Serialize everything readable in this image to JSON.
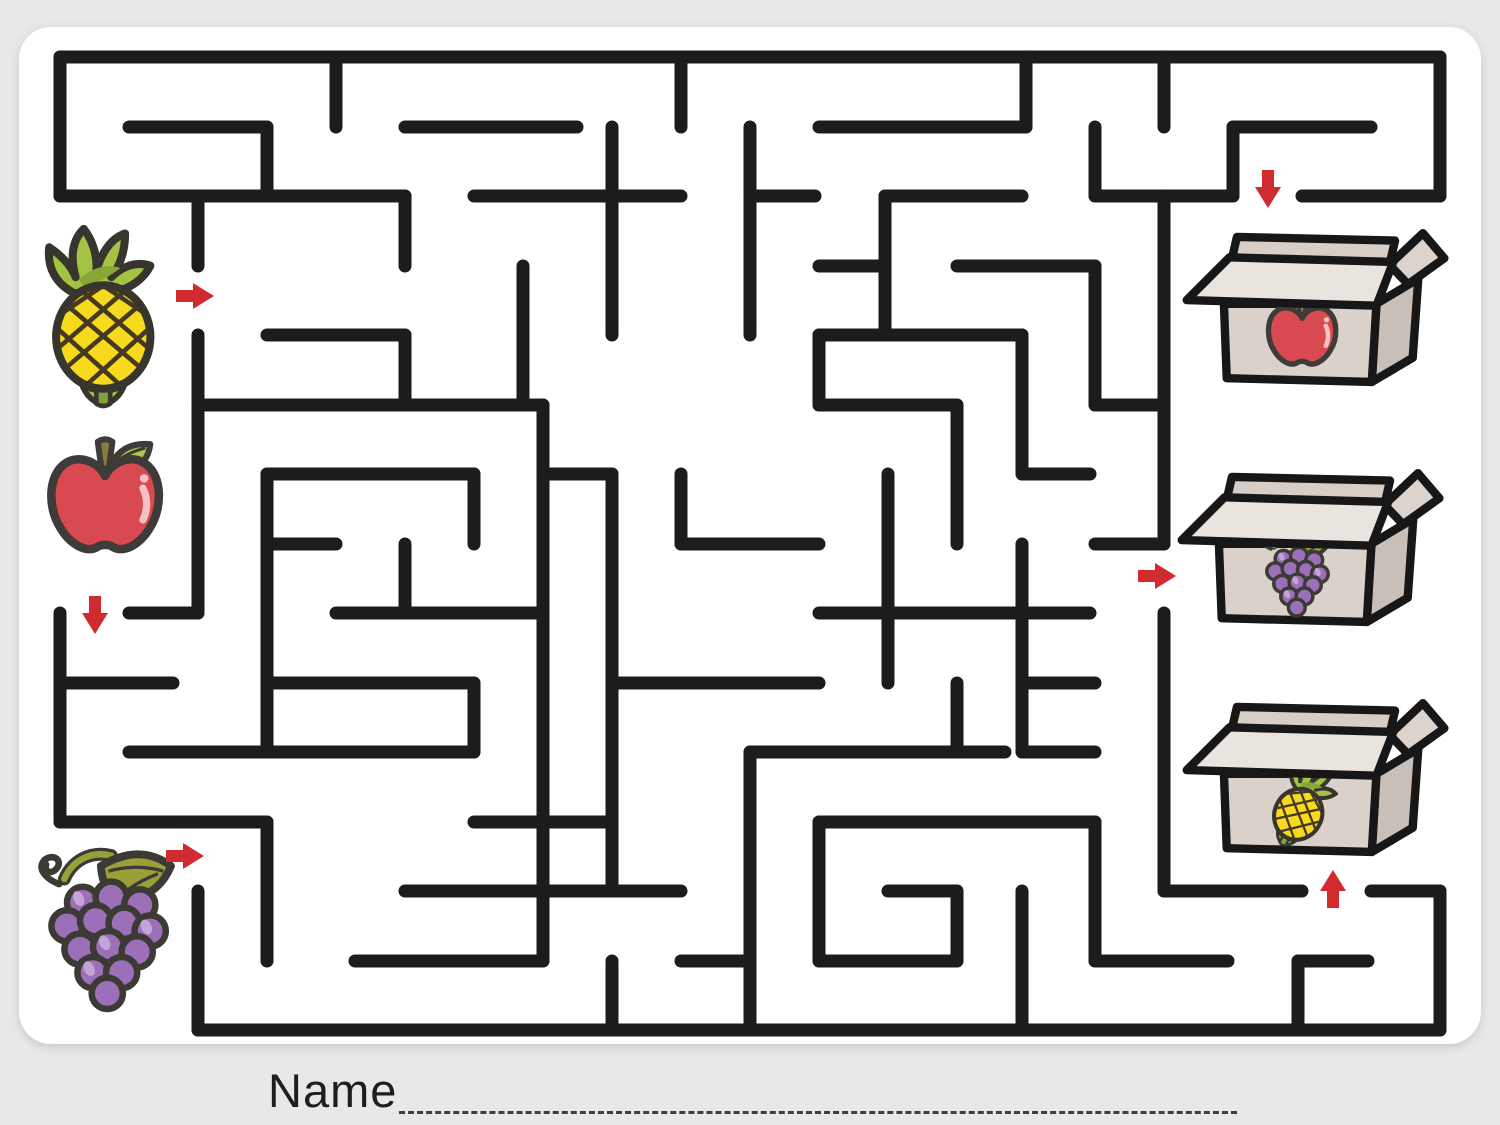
{
  "worksheet": {
    "title_label": "Name",
    "background_color": "#e7e8e9",
    "card_color": "#ffffff"
  },
  "maze": {
    "wall_color": "#1d1c1a",
    "stroke_width": 13,
    "walls": [
      [
        60,
        57,
        1440,
        57
      ],
      [
        1440,
        57,
        1440,
        196
      ],
      [
        1302,
        196,
        1440,
        196
      ],
      [
        1233,
        127,
        1233,
        196
      ],
      [
        1233,
        127,
        1371,
        127
      ],
      [
        1164,
        57,
        1164,
        127
      ],
      [
        1095,
        127,
        1095,
        196
      ],
      [
        1095,
        196,
        1233,
        196
      ],
      [
        1164,
        196,
        1164,
        544
      ],
      [
        1095,
        544,
        1164,
        544
      ],
      [
        1164,
        613,
        1164,
        891
      ],
      [
        1164,
        891,
        1302,
        891
      ],
      [
        1371,
        891,
        1440,
        891
      ],
      [
        1440,
        891,
        1440,
        1030
      ],
      [
        198,
        1030,
        1440,
        1030
      ],
      [
        198,
        891,
        198,
        1030
      ],
      [
        60,
        822,
        267,
        822
      ],
      [
        267,
        822,
        267,
        961
      ],
      [
        60,
        613,
        60,
        822
      ],
      [
        129,
        613,
        198,
        613
      ],
      [
        198,
        335,
        198,
        613
      ],
      [
        198,
        196,
        198,
        266
      ],
      [
        60,
        196,
        198,
        196
      ],
      [
        60,
        57,
        60,
        196
      ],
      [
        129,
        127,
        267,
        127
      ],
      [
        267,
        127,
        267,
        196
      ],
      [
        336,
        57,
        336,
        127
      ],
      [
        405,
        127,
        577,
        127
      ],
      [
        198,
        196,
        405,
        196
      ],
      [
        405,
        196,
        405,
        266
      ],
      [
        405,
        335,
        405,
        405
      ],
      [
        267,
        335,
        405,
        335
      ],
      [
        523,
        266,
        523,
        405
      ],
      [
        198,
        405,
        543,
        405
      ],
      [
        543,
        405,
        543,
        961
      ],
      [
        267,
        474,
        474,
        474
      ],
      [
        474,
        474,
        474,
        544
      ],
      [
        267,
        544,
        336,
        544
      ],
      [
        405,
        544,
        405,
        613
      ],
      [
        336,
        613,
        543,
        613
      ],
      [
        267,
        683,
        474,
        683
      ],
      [
        267,
        474,
        267,
        752
      ],
      [
        129,
        752,
        474,
        752
      ],
      [
        474,
        683,
        474,
        752
      ],
      [
        612,
        127,
        612,
        335
      ],
      [
        474,
        196,
        681,
        196
      ],
      [
        681,
        57,
        681,
        127
      ],
      [
        819,
        127,
        1026,
        127
      ],
      [
        1026,
        57,
        1026,
        127
      ],
      [
        750,
        127,
        750,
        335
      ],
      [
        750,
        196,
        815,
        196
      ],
      [
        885,
        196,
        1022,
        196
      ],
      [
        885,
        196,
        885,
        335
      ],
      [
        819,
        266,
        885,
        266
      ],
      [
        957,
        266,
        1095,
        266
      ],
      [
        1095,
        266,
        1095,
        405
      ],
      [
        1095,
        405,
        1164,
        405
      ],
      [
        819,
        335,
        1022,
        335
      ],
      [
        819,
        335,
        819,
        405
      ],
      [
        1022,
        335,
        1022,
        474
      ],
      [
        1022,
        474,
        1090,
        474
      ],
      [
        819,
        405,
        957,
        405
      ],
      [
        957,
        405,
        957,
        544
      ],
      [
        543,
        474,
        612,
        474
      ],
      [
        612,
        474,
        612,
        891
      ],
      [
        681,
        474,
        681,
        544
      ],
      [
        681,
        544,
        819,
        544
      ],
      [
        888,
        474,
        888,
        683
      ],
      [
        819,
        613,
        1090,
        613
      ],
      [
        1022,
        544,
        1022,
        752
      ],
      [
        612,
        683,
        819,
        683
      ],
      [
        1026,
        683,
        1095,
        683
      ],
      [
        957,
        683,
        957,
        752
      ],
      [
        750,
        752,
        1005,
        752
      ],
      [
        750,
        752,
        750,
        1030
      ],
      [
        1022,
        752,
        1095,
        752
      ],
      [
        819,
        822,
        1095,
        822
      ],
      [
        819,
        822,
        819,
        961
      ],
      [
        819,
        961,
        957,
        961
      ],
      [
        957,
        891,
        957,
        961
      ],
      [
        888,
        891,
        957,
        891
      ],
      [
        1095,
        822,
        1095,
        961
      ],
      [
        1095,
        961,
        1228,
        961
      ],
      [
        1298,
        961,
        1298,
        1030
      ],
      [
        1298,
        961,
        1368,
        961
      ],
      [
        1022,
        891,
        1022,
        1030
      ],
      [
        405,
        891,
        681,
        891
      ],
      [
        355,
        961,
        543,
        961
      ],
      [
        612,
        961,
        612,
        1030
      ],
      [
        681,
        961,
        750,
        961
      ],
      [
        474,
        822,
        612,
        822
      ],
      [
        60,
        683,
        173,
        683
      ]
    ]
  },
  "arrow": {
    "color": "#d02b2f"
  },
  "arrows": [
    {
      "name": "pineapple-start-arrow",
      "x": 176,
      "y": 296,
      "dir": "right"
    },
    {
      "name": "apple-start-arrow",
      "x": 95,
      "y": 596,
      "dir": "down"
    },
    {
      "name": "grapes-start-arrow",
      "x": 166,
      "y": 856,
      "dir": "right"
    },
    {
      "name": "apple-box-arrow",
      "x": 1268,
      "y": 170,
      "dir": "down"
    },
    {
      "name": "grapes-box-arrow",
      "x": 1138,
      "y": 576,
      "dir": "right"
    },
    {
      "name": "pineapple-box-arrow",
      "x": 1333,
      "y": 908,
      "dir": "up"
    }
  ],
  "start_items": [
    {
      "fruit": "pineapple",
      "x": 40,
      "y": 222,
      "scale": 1.15
    },
    {
      "fruit": "apple",
      "x": 38,
      "y": 432,
      "scale": 1.22
    },
    {
      "fruit": "grapes",
      "x": 28,
      "y": 840,
      "scale": 1.3
    }
  ],
  "boxes": [
    {
      "contains": "apple",
      "x": 1183,
      "y": 222,
      "scale": 0.93,
      "fruit": {
        "x": 83,
        "y": 74,
        "scale": 0.82,
        "rotate": 0
      }
    },
    {
      "contains": "grapes",
      "x": 1178,
      "y": 462,
      "scale": 0.93,
      "fruit": {
        "x": 82,
        "y": 68,
        "scale": 0.75,
        "rotate": 0
      }
    },
    {
      "contains": "pineapple",
      "x": 1183,
      "y": 692,
      "scale": 0.93,
      "fruit": {
        "x": 100,
        "y": 72,
        "scale": 0.62,
        "rotate": 28
      }
    }
  ],
  "palette": {
    "pineapple_body": "#f7d91d",
    "pineapple_leaf": "#a3c343",
    "pineapple_hatch": "#453a20",
    "apple_body": "#d84a50",
    "apple_leaf": "#a9c94a",
    "apple_stem": "#8a7d42",
    "apple_highlight": "#f4c2c5",
    "grape_berry": "#9c70b8",
    "grape_highlight": "#c4a3d6",
    "grape_leaf": "#99a03a",
    "outline": "#3b3833",
    "box_front": "#d9d1ca",
    "box_side": "#c8bfb8",
    "box_flap": "#eae4de",
    "box_inner": "#d6cec7",
    "box_outline": "#171717"
  }
}
